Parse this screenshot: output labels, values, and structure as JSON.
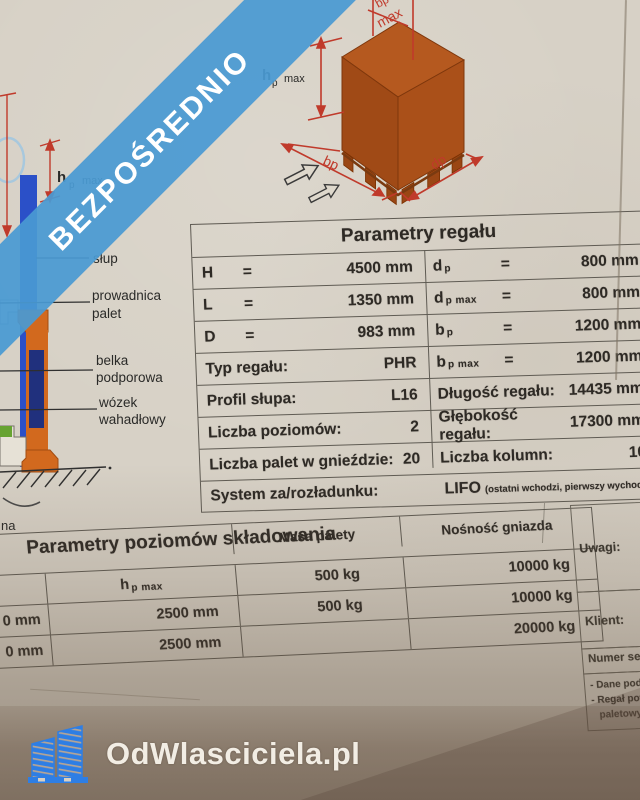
{
  "banner": {
    "text": "BEZPOŚREDNIO"
  },
  "footer": {
    "site": "OdWlasciciela.pl"
  },
  "top_diagram": {
    "dim_bp_max_line1": "bp",
    "dim_bp_max_line2": "max",
    "dim_hp_main": "h",
    "dim_hp_sub": "p",
    "dim_hp_max": "max",
    "dim_bp": "bp",
    "dim_dp": "dp"
  },
  "left_diagram": {
    "dim_hp_main": "h",
    "dim_hp_sub": "p",
    "dim_hp_max": "max",
    "label_slup": "słup",
    "label_prowadnica_1": "prowadnica",
    "label_prowadnica_2": "palet",
    "label_belka_1": "belka",
    "label_belka_2": "podporowa",
    "label_wozek_1": "wózek",
    "label_wozek_2": "wahadłowy",
    "label_partial": "na"
  },
  "table1": {
    "title": "Parametry regału",
    "left_rows": [
      {
        "label": "H",
        "eq": "=",
        "value": "4500 mm"
      },
      {
        "label": "L",
        "eq": "=",
        "value": "1350 mm"
      },
      {
        "label": "D",
        "eq": "=",
        "value": "983 mm"
      },
      {
        "label": "Typ regału:",
        "eq": "",
        "value": "PHR"
      },
      {
        "label": "Profil słupa:",
        "eq": "",
        "value": "L16"
      },
      {
        "label": "Liczba poziomów:",
        "eq": "",
        "value": "2"
      },
      {
        "label": "Liczba palet w gnieździe:",
        "eq": "",
        "value": "20"
      }
    ],
    "right_rows": [
      {
        "main": "d",
        "sub": "p",
        "eq": "=",
        "value": "800 mm"
      },
      {
        "main": "d",
        "sub": "p max",
        "eq": "=",
        "value": "800 mm"
      },
      {
        "main": "b",
        "sub": "p",
        "eq": "=",
        "value": "1200 mm"
      },
      {
        "main": "b",
        "sub": "p max",
        "eq": "=",
        "value": "1200 mm"
      },
      {
        "main": "Długość regału:",
        "sub": "",
        "eq": "",
        "value": "14435 mm"
      },
      {
        "main": "Głębokość regału:",
        "sub": "",
        "eq": "",
        "value": "17300 mm"
      },
      {
        "main": "Liczba kolumn:",
        "sub": "",
        "eq": "",
        "value": "10"
      }
    ],
    "system_row": {
      "label": "System za/rozładunku:",
      "value": "LIFO",
      "note": "(ostatni wchodzi, pierwszy wychodzi)"
    }
  },
  "table2": {
    "title": "Parametry poziomów składowania",
    "header_h_main": "h",
    "header_h_sub": "p max",
    "header_masa": "Masa palety",
    "header_nosnosc": "Nośność gniazda",
    "rows": [
      {
        "c1": "",
        "c2": "",
        "c3": "500 kg",
        "c4": "10000 kg"
      },
      {
        "c1": "0 mm",
        "c2": "2500 mm",
        "c3": "500 kg",
        "c4": "10000 kg"
      },
      {
        "c1": "0 mm",
        "c2": "2500 mm",
        "c3": "",
        "c4": "20000 kg"
      }
    ]
  },
  "side_panel": {
    "uwagi": "Uwagi:",
    "klient": "Klient:",
    "numer": "Numer sery",
    "note1": "- Dane pod",
    "note2": "- Regał pow",
    "note3": "paletowyc"
  },
  "colors": {
    "banner_blue": "#499ad3",
    "logo_blue": "#2e7ee4",
    "dim_red": "#c03a2b",
    "rack_orange": "#d2691e",
    "column_blue": "#2b50c8"
  }
}
